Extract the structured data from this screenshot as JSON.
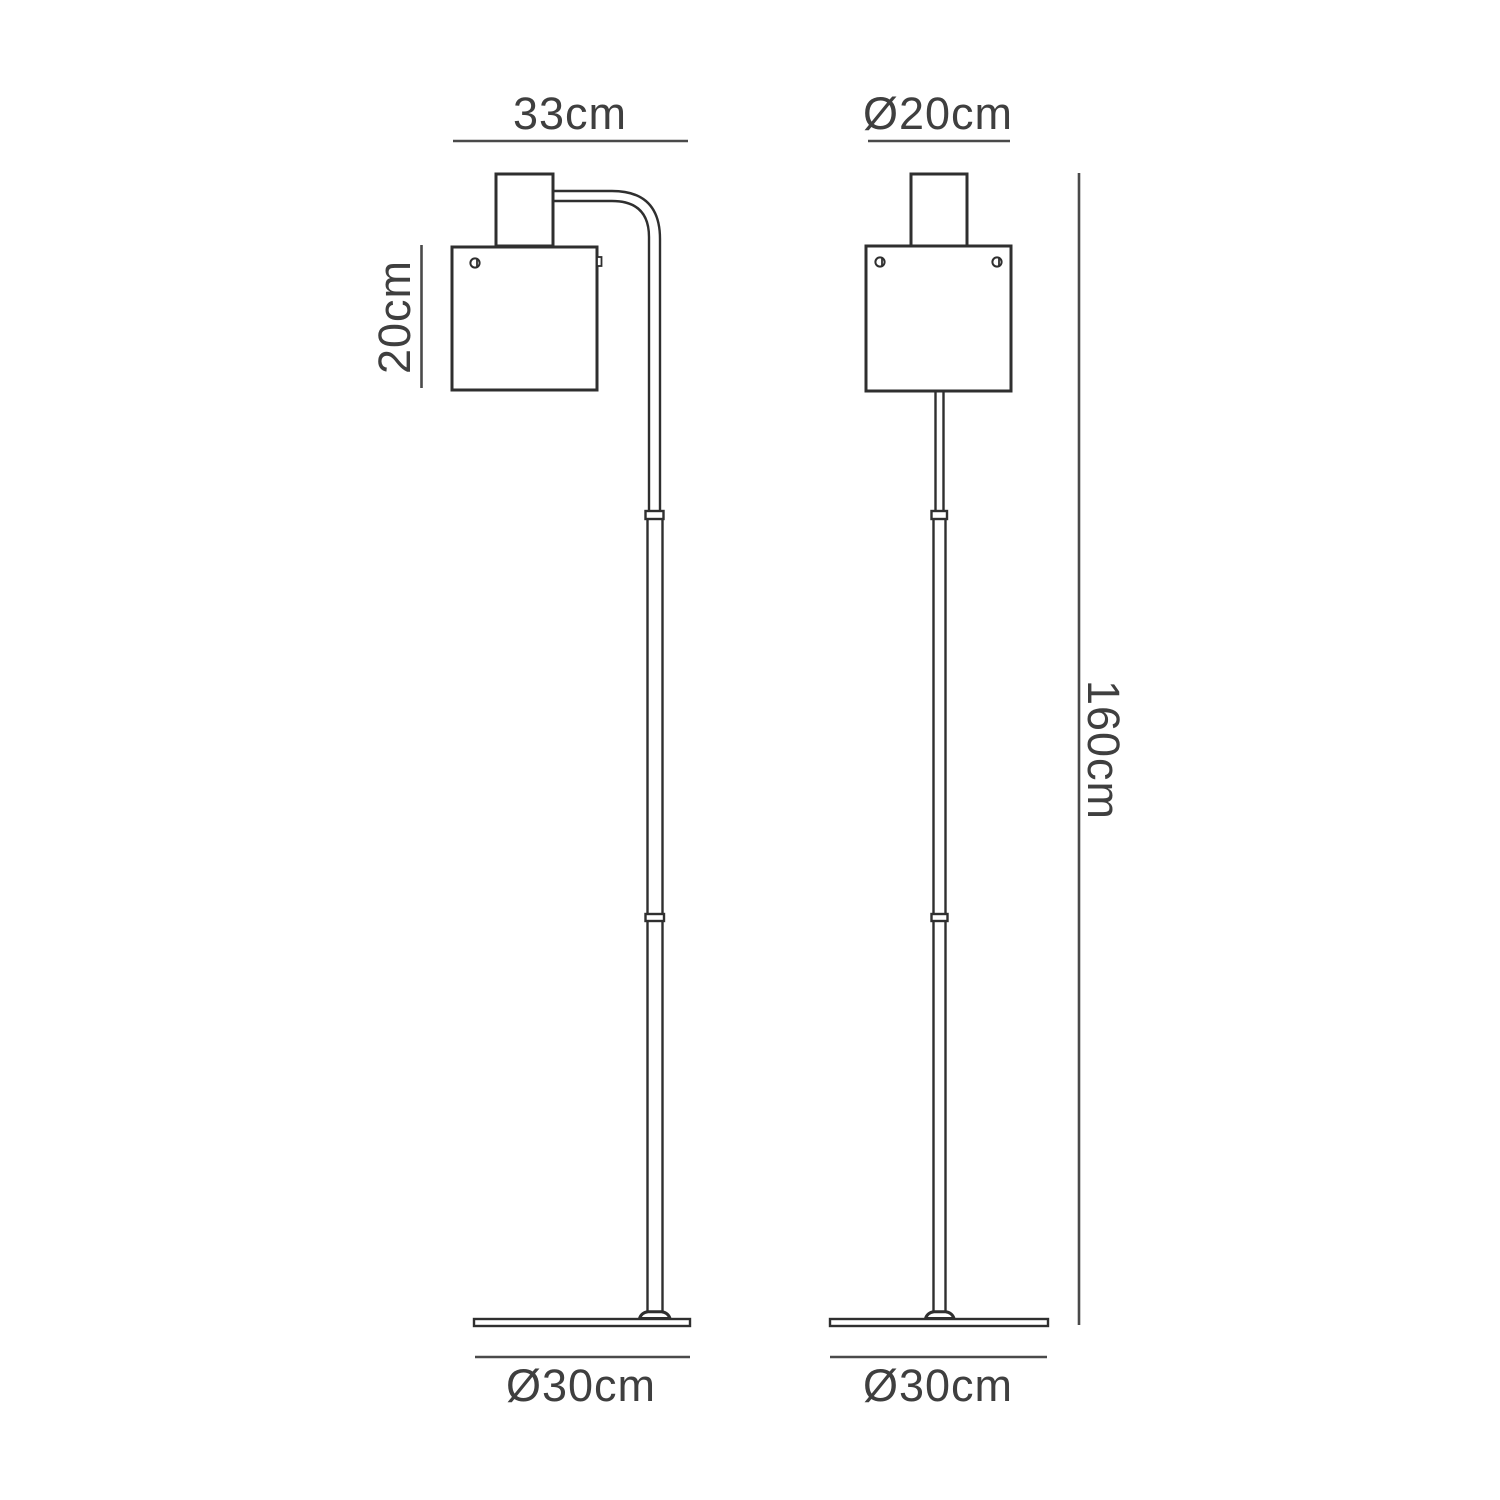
{
  "diagram": {
    "subject": "floor lamp technical dimension drawing, front and side elevation views",
    "colors": {
      "background": "#ffffff",
      "outline": "#2f2f2f",
      "dimension_line": "#4a4a4a",
      "dimension_text": "#3f3f3f"
    },
    "views": {
      "front": {
        "width_label": "33cm",
        "shade_height_label": "20cm",
        "base_diameter_label": "Ø30cm"
      },
      "side": {
        "shade_diameter_label": "Ø20cm",
        "total_height_label": "160cm",
        "base_diameter_label": "Ø30cm"
      }
    }
  }
}
